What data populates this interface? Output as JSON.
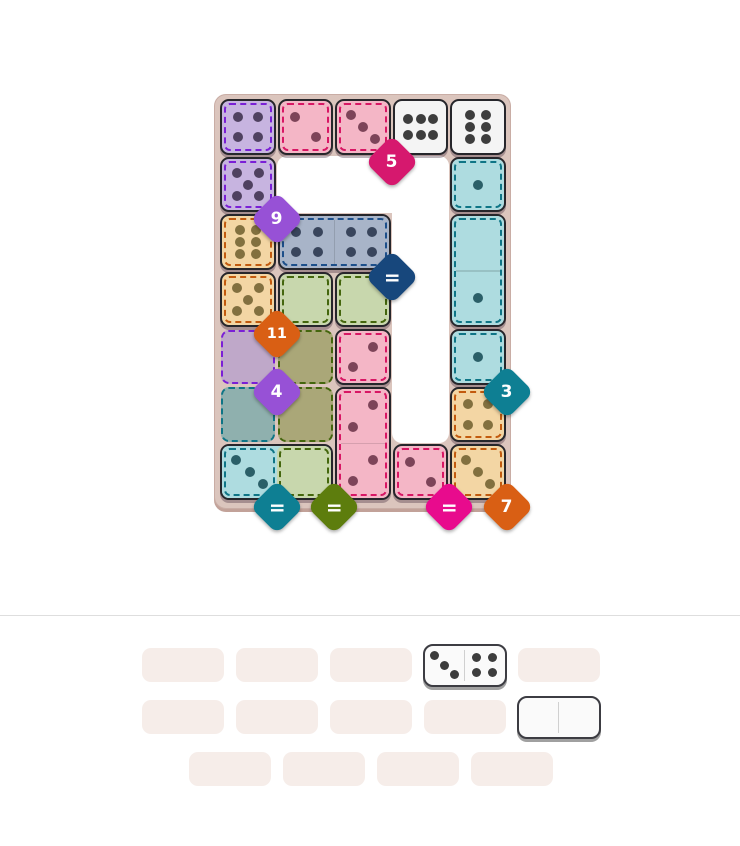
{
  "game": {
    "board": {
      "grid": {
        "rows": 7,
        "cols": 5
      },
      "hole_cells": [
        [
          2,
          2
        ],
        [
          2,
          3
        ],
        [
          2,
          4
        ],
        [
          3,
          4
        ],
        [
          4,
          4
        ],
        [
          5,
          4
        ],
        [
          6,
          4
        ]
      ],
      "regions": [
        {
          "id": "purple-1",
          "color": "purple",
          "target": "9",
          "cells": [
            [
              1,
              1
            ],
            [
              2,
              1
            ]
          ],
          "badge_color": "#9751d6",
          "badge_corner": [
            1,
            2
          ]
        },
        {
          "id": "crimson-1",
          "color": "crimson",
          "target": "5",
          "cells": [
            [
              1,
              2
            ],
            [
              1,
              3
            ]
          ],
          "badge_color": "#d6186e",
          "badge_corner": [
            3,
            1
          ]
        },
        {
          "id": "navy-1",
          "color": "navy",
          "target": "=",
          "cells": [
            [
              3,
              2
            ],
            [
              3,
              3
            ]
          ],
          "badge_color": "#17477c",
          "badge_corner": [
            3,
            3
          ]
        },
        {
          "id": "orange-1",
          "color": "orange",
          "target": "11",
          "cells": [
            [
              3,
              1
            ],
            [
              4,
              1
            ]
          ],
          "badge_color": "#d95f14",
          "badge_corner": [
            1,
            4
          ]
        },
        {
          "id": "purple-2",
          "color": "purple",
          "target": "4",
          "cells": [
            [
              5,
              1
            ]
          ],
          "badge_color": "#9751d6",
          "badge_corner": [
            1,
            5
          ]
        },
        {
          "id": "teal-2",
          "color": "teal",
          "target": "=",
          "cells": [
            [
              6,
              1
            ],
            [
              7,
              1
            ]
          ],
          "badge_color": "#0e7f93",
          "badge_corner": [
            1,
            7
          ]
        },
        {
          "id": "green-1",
          "color": "green",
          "target": "=",
          "cells": [
            [
              4,
              2
            ],
            [
              4,
              3
            ],
            [
              5,
              2
            ],
            [
              6,
              2
            ],
            [
              7,
              2
            ]
          ],
          "badge_color": "#5d7d0d",
          "badge_corner": [
            2,
            7
          ]
        },
        {
          "id": "crimson-2",
          "color": "crimson",
          "target": "=",
          "cells": [
            [
              5,
              3
            ],
            [
              6,
              3
            ],
            [
              7,
              3
            ],
            [
              7,
              4
            ]
          ],
          "badge_color": "#e80b8d",
          "badge_corner": [
            4,
            7
          ]
        },
        {
          "id": "teal-1",
          "color": "teal",
          "target": "3",
          "cells": [
            [
              2,
              5
            ],
            [
              3,
              5
            ],
            [
              4,
              5
            ],
            [
              5,
              5
            ]
          ],
          "badge_color": "#0e7f93",
          "badge_corner": [
            5,
            5
          ]
        },
        {
          "id": "orange-2",
          "color": "orange",
          "target": "7",
          "cells": [
            [
              6,
              5
            ],
            [
              7,
              5
            ]
          ],
          "badge_color": "#d95f14",
          "badge_corner": [
            5,
            7
          ]
        }
      ],
      "given_cells": [
        {
          "r": 1,
          "c": 1,
          "region": "purple",
          "pips": 4,
          "layout": "4"
        },
        {
          "r": 2,
          "c": 1,
          "region": "purple",
          "pips": 5,
          "layout": "5"
        },
        {
          "r": 1,
          "c": 2,
          "region": "crimson",
          "pips": 2,
          "layout": "2tlbr"
        },
        {
          "r": 1,
          "c": 3,
          "region": "crimson",
          "pips": 3,
          "layout": "3tlbr"
        },
        {
          "r": 1,
          "c": 4,
          "region": "white",
          "pips": 6,
          "layout": "6h"
        },
        {
          "r": 1,
          "c": 5,
          "region": "white",
          "pips": 6,
          "layout": "6v"
        },
        {
          "r": 2,
          "c": 5,
          "region": "teal",
          "pips": 1,
          "layout": "1"
        },
        {
          "r": 3,
          "c": 1,
          "region": "orange",
          "pips": 6,
          "layout": "6v"
        },
        {
          "r": 4,
          "c": 1,
          "region": "orange",
          "pips": 5,
          "layout": "5"
        },
        {
          "r": 4,
          "c": 2,
          "region": "green",
          "pips": 0,
          "layout": "0"
        },
        {
          "r": 4,
          "c": 3,
          "region": "green",
          "pips": 0,
          "layout": "0"
        },
        {
          "r": 5,
          "c": 3,
          "region": "crimson",
          "pips": 2,
          "layout": "2trbl"
        },
        {
          "r": 5,
          "c": 5,
          "region": "teal",
          "pips": 1,
          "layout": "1"
        },
        {
          "r": 6,
          "c": 5,
          "region": "orange",
          "pips": 4,
          "layout": "4"
        },
        {
          "r": 7,
          "c": 4,
          "region": "crimson",
          "pips": 2,
          "layout": "2tlbr"
        },
        {
          "r": 7,
          "c": 5,
          "region": "orange",
          "pips": 3,
          "layout": "3tlbr"
        }
      ],
      "placed_dominoes": [
        {
          "r": 3,
          "c": 2,
          "orient": "h",
          "dash": "union",
          "halves": [
            {
              "region": "navy",
              "pips": 4,
              "layout": "4"
            },
            {
              "region": "navy",
              "pips": 4,
              "layout": "4"
            }
          ]
        },
        {
          "r": 3,
          "c": 5,
          "orient": "v",
          "dash": "union",
          "halves": [
            {
              "region": "teal",
              "pips": 0,
              "layout": "0"
            },
            {
              "region": "teal",
              "pips": 1,
              "layout": "1"
            }
          ]
        },
        {
          "r": 6,
          "c": 3,
          "orient": "v",
          "dash": "union",
          "halves": [
            {
              "region": "crimson",
              "pips": 2,
              "layout": "2trbl"
            },
            {
              "region": "crimson",
              "pips": 2,
              "layout": "2trbl"
            }
          ]
        },
        {
          "r": 7,
          "c": 1,
          "orient": "h",
          "dash": "halves",
          "halves": [
            {
              "region": "teal",
              "pips": 3,
              "layout": "3tlbr"
            },
            {
              "region": "green",
              "pips": 0,
              "layout": "0"
            }
          ]
        }
      ],
      "empty_cells": [
        {
          "r": 5,
          "c": 1,
          "region": "purple"
        },
        {
          "r": 6,
          "c": 1,
          "region": "teal"
        },
        {
          "r": 5,
          "c": 2,
          "region": "green"
        },
        {
          "r": 6,
          "c": 2,
          "region": "green"
        }
      ]
    },
    "tray": {
      "rows": [
        {
          "slots": 5
        },
        {
          "slots": 5
        },
        {
          "slots": 4
        }
      ],
      "pieces": [
        {
          "row": 1,
          "slot": 4,
          "halves": [
            {
              "pips": 3,
              "layout": "3tlbr"
            },
            {
              "pips": 4,
              "layout": "4"
            }
          ]
        },
        {
          "row": 2,
          "slot": 5,
          "halves": [
            {
              "pips": 0,
              "layout": "0"
            },
            {
              "pips": 0,
              "layout": "0"
            }
          ]
        }
      ]
    }
  },
  "palette": {
    "page_bg": "#ffffff",
    "panel": "#dbc5bd",
    "hole": "#ffffff",
    "divider": "#dedede",
    "slot": "#f6ede9",
    "piece_border": "#26262b",
    "regions": {
      "purple": {
        "fill": "#c7b4e0",
        "muted": "#bfa8c9",
        "dash": "#7a1fd6",
        "pip": "#4f4160"
      },
      "crimson": {
        "fill": "#f4b6c6",
        "muted": "#e8aebe",
        "dash": "#d81664",
        "pip": "#7d4459"
      },
      "navy": {
        "fill": "#a8b4c8",
        "muted": "#a8b4c8",
        "dash": "#1d4f8a",
        "pip": "#39455c"
      },
      "orange": {
        "fill": "#f3d6a4",
        "muted": "#e5c89a",
        "dash": "#c25a0e",
        "pip": "#82703f"
      },
      "green": {
        "fill": "#c8d7ad",
        "muted": "#aaa778",
        "dash": "#44660d",
        "pip": "#55603a"
      },
      "teal": {
        "fill": "#aedce0",
        "muted": "#8fb0ae",
        "dash": "#0e7586",
        "pip": "#2b5f68"
      },
      "white": {
        "fill": "#f4f4f4",
        "muted": "#f4f4f4",
        "dash": "",
        "pip": "#3d3d3d"
      }
    },
    "tray_pip": "#3d3d3d"
  }
}
